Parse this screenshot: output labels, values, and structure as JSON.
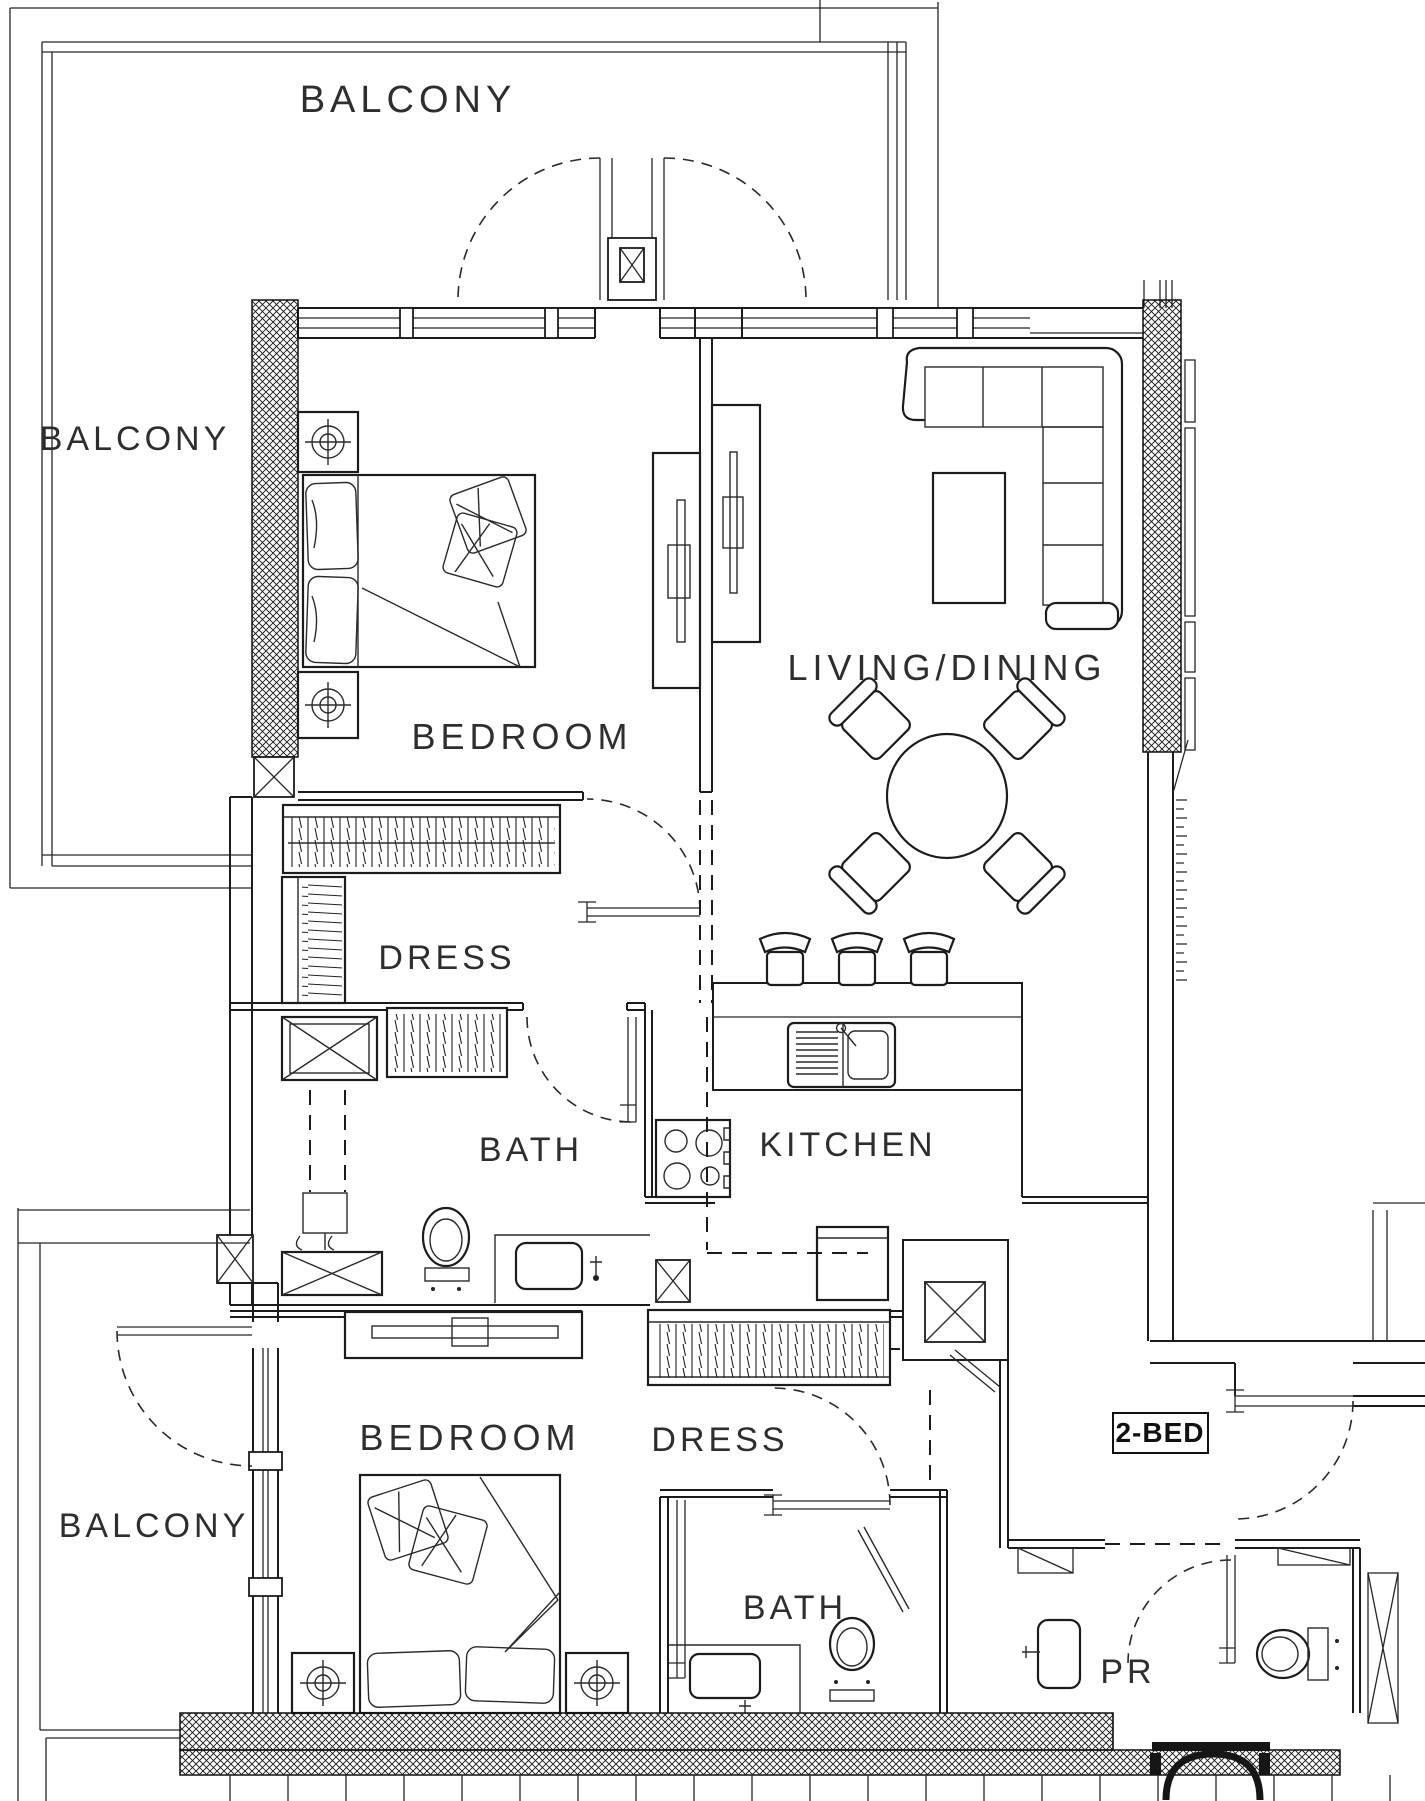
{
  "unit": {
    "type_label": "2-BED"
  },
  "rooms": {
    "balcony_top": "BALCONY",
    "balcony_left": "BALCONY",
    "balcony_bottom": "BALCONY",
    "bedroom_1": "BEDROOM",
    "living_dining": "LIVING/DINING",
    "dress_1": "DRESS",
    "bath_1": "BATH",
    "kitchen": "KITCHEN",
    "bedroom_2": "BEDROOM",
    "dress_2": "DRESS",
    "bath_2": "BATH",
    "powder_room": "PR"
  },
  "colors": {
    "line": "#1c1c1c",
    "background": "#ffffff"
  },
  "drawing": {
    "kind": "apartment floor plan",
    "furniture": [
      "double bed x2",
      "nightstand x4",
      "wardrobe closets",
      "L-shaped sofa",
      "coffee table",
      "round dining table with 4 chairs",
      "3 bar stools",
      "kitchen sink",
      "4-burner stove",
      "fridge",
      "toilet x3",
      "vanity basin x3",
      "shower x2",
      "washing machine"
    ]
  }
}
